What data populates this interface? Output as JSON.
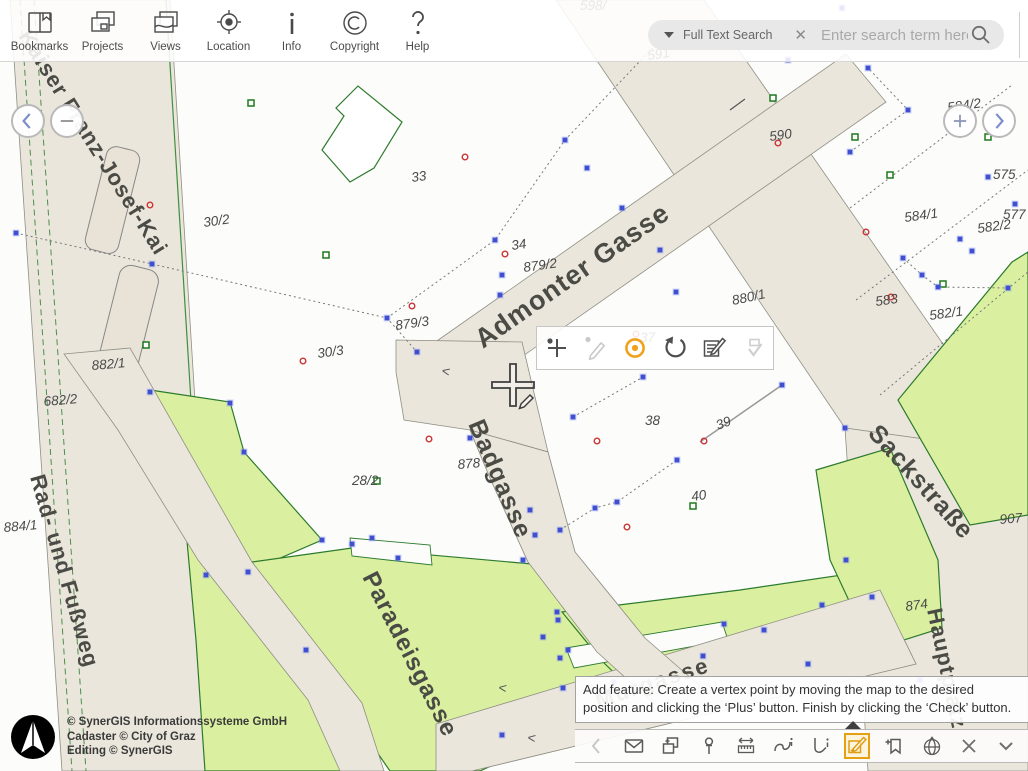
{
  "app_toolbar": {
    "items": [
      {
        "label": "Bookmarks",
        "icon": "book-icon"
      },
      {
        "label": "Projects",
        "icon": "windows-icon"
      },
      {
        "label": "Views",
        "icon": "map-sheet-icon"
      },
      {
        "label": "Location",
        "icon": "target-icon"
      },
      {
        "label": "Info",
        "icon": "info-icon"
      },
      {
        "label": "Copyright",
        "icon": "copyright-icon"
      },
      {
        "label": "Help",
        "icon": "question-icon"
      }
    ]
  },
  "search": {
    "mode_label": "Full Text Search",
    "clear_glyph": "✕",
    "placeholder": "Enter search term here"
  },
  "nav": {
    "pan_left": "chevron-left",
    "zoom_out": "minus",
    "zoom_in": "plus",
    "pan_right": "chevron-right"
  },
  "edit_toolbar": {
    "tools": [
      {
        "name": "add-vertex",
        "state": "enabled"
      },
      {
        "name": "sketch-pencil",
        "state": "disabled"
      },
      {
        "name": "snap-point",
        "state": "active"
      },
      {
        "name": "undo",
        "state": "enabled"
      },
      {
        "name": "edit-attributes",
        "state": "enabled"
      },
      {
        "name": "finish-check",
        "state": "disabled"
      }
    ],
    "accent_color": "#f0a21d"
  },
  "tooltip": {
    "text": "Add feature: Create a vertex point by moving the map to the desired position and clicking the ‘Plus’ button. Finish by clicking the ‘Check’ button."
  },
  "bottom_toolbar": {
    "tools": [
      "previous",
      "email",
      "copy-compare",
      "pin",
      "measure",
      "line-info",
      "area-info",
      "edit-redlining",
      "bookmark-add",
      "globe",
      "close",
      "collapse"
    ],
    "active_tool": "edit-redlining"
  },
  "attribution": {
    "lines": [
      "© SynerGIS Informationssysteme GmbH",
      "Cadaster © City of Graz",
      "Editing © SynerGIS"
    ]
  },
  "map": {
    "colors": {
      "street_fill": "#ebe6dc",
      "green_fill": "#daf0a0",
      "green_stroke": "#2c7a2c",
      "vertex_blue": "#3f4fd0",
      "point_red": "#cc3333",
      "square_green": "#1d7a1d",
      "label_color": "#4a4a4a"
    },
    "street_labels": [
      {
        "t": "Kaiser Franz-Josef-Kai",
        "x": 18,
        "y": 36,
        "r": 58,
        "s": 22,
        "ls": 1
      },
      {
        "t": "Rad- und Fußweg",
        "x": 30,
        "y": 477,
        "r": 74,
        "s": 22,
        "ls": 1
      },
      {
        "t": "Admonter Gasse",
        "x": 483,
        "y": 349,
        "r": -35,
        "s": 27,
        "ls": 1
      },
      {
        "t": "Badgasse",
        "x": 468,
        "y": 424,
        "r": 67,
        "s": 25,
        "ls": 1
      },
      {
        "t": "Paradeisgasse",
        "x": 362,
        "y": 577,
        "r": 63,
        "s": 24,
        "ls": 1
      },
      {
        "t": "Sackstraße",
        "x": 867,
        "y": 434,
        "r": 48,
        "s": 25,
        "ls": 1
      },
      {
        "t": "Hauptplatz",
        "x": 927,
        "y": 610,
        "r": 78,
        "s": 22,
        "ls": 1
      },
      {
        "t": "Murgasse",
        "x": 598,
        "y": 708,
        "r": -18,
        "s": 22,
        "ls": 2
      }
    ],
    "parcel_labels": [
      {
        "t": "33",
        "x": 412,
        "y": 182,
        "r": -8
      },
      {
        "t": "30/2",
        "x": 204,
        "y": 227,
        "r": -8
      },
      {
        "t": "34",
        "x": 512,
        "y": 250,
        "r": -8
      },
      {
        "t": "879/2",
        "x": 524,
        "y": 272,
        "r": -8
      },
      {
        "t": "879/3",
        "x": 396,
        "y": 330,
        "r": -8
      },
      {
        "t": "30/3",
        "x": 318,
        "y": 358,
        "r": -8
      },
      {
        "t": "28/2",
        "x": 352,
        "y": 485,
        "r": 0
      },
      {
        "t": "878",
        "x": 458,
        "y": 469,
        "r": -5
      },
      {
        "t": "38",
        "x": 645,
        "y": 425,
        "r": 0
      },
      {
        "t": "39",
        "x": 718,
        "y": 430,
        "r": -21
      },
      {
        "t": "40",
        "x": 692,
        "y": 501,
        "r": -8
      },
      {
        "t": "880/1",
        "x": 733,
        "y": 305,
        "r": -12
      },
      {
        "t": "882/1",
        "x": 92,
        "y": 370,
        "r": -5
      },
      {
        "t": "682/2",
        "x": 44,
        "y": 406,
        "r": -5
      },
      {
        "t": "884/1",
        "x": 4,
        "y": 532,
        "r": -5
      },
      {
        "t": "583",
        "x": 876,
        "y": 306,
        "r": -8
      },
      {
        "t": "582/1",
        "x": 930,
        "y": 320,
        "r": -8
      },
      {
        "t": "584/1",
        "x": 905,
        "y": 222,
        "r": -8
      },
      {
        "t": "575",
        "x": 993,
        "y": 179,
        "r": 0
      },
      {
        "t": "577",
        "x": 1003,
        "y": 219,
        "r": 0
      },
      {
        "t": "582/2",
        "x": 978,
        "y": 233,
        "r": -8
      },
      {
        "t": "584/2",
        "x": 948,
        "y": 112,
        "r": -8
      },
      {
        "t": "590",
        "x": 770,
        "y": 141,
        "r": -8
      },
      {
        "t": "591",
        "x": 648,
        "y": 60,
        "r": -8
      },
      {
        "t": "589",
        "x": 950,
        "y": 46,
        "r": 0
      },
      {
        "t": "598/",
        "x": 580,
        "y": 10,
        "r": 0
      },
      {
        "t": "907",
        "x": 1000,
        "y": 524,
        "r": -5
      },
      {
        "t": "874",
        "x": 906,
        "y": 611,
        "r": -8
      },
      {
        "t": "37",
        "x": 640,
        "y": 342,
        "r": 0
      }
    ],
    "symbols": {
      "vertices": [
        [
          16,
          233
        ],
        [
          152,
          264
        ],
        [
          387,
          318
        ],
        [
          417,
          352
        ],
        [
          495,
          240
        ],
        [
          565,
          140
        ],
        [
          660,
          40
        ],
        [
          587,
          168
        ],
        [
          622,
          208
        ],
        [
          502,
          275
        ],
        [
          500,
          295
        ],
        [
          573,
          417
        ],
        [
          643,
          377
        ],
        [
          677,
          460
        ],
        [
          782,
          385
        ],
        [
          617,
          502
        ],
        [
          595,
          508
        ],
        [
          560,
          530
        ],
        [
          470,
          438
        ],
        [
          530,
          510
        ],
        [
          535,
          535
        ],
        [
          523,
          560
        ],
        [
          557,
          612
        ],
        [
          558,
          620
        ],
        [
          543,
          637
        ],
        [
          560,
          658
        ],
        [
          563,
          688
        ],
        [
          502,
          735
        ],
        [
          352,
          544
        ],
        [
          372,
          538
        ],
        [
          398,
          558
        ],
        [
          150,
          392
        ],
        [
          230,
          403
        ],
        [
          244,
          452
        ],
        [
          322,
          540
        ],
        [
          248,
          572
        ],
        [
          868,
          68
        ],
        [
          908,
          110
        ],
        [
          850,
          152
        ],
        [
          988,
          177
        ],
        [
          1015,
          204
        ],
        [
          960,
          239
        ],
        [
          972,
          251
        ],
        [
          903,
          258
        ],
        [
          922,
          275
        ],
        [
          938,
          287
        ],
        [
          1008,
          288
        ],
        [
          845,
          428
        ],
        [
          872,
          597
        ],
        [
          846,
          560
        ],
        [
          808,
          664
        ],
        [
          920,
          680
        ],
        [
          788,
          60
        ],
        [
          842,
          8
        ],
        [
          660,
          250
        ],
        [
          676,
          292
        ],
        [
          206,
          575
        ],
        [
          306,
          650
        ],
        [
          614,
          682
        ],
        [
          703,
          656
        ],
        [
          764,
          630
        ],
        [
          822,
          605
        ],
        [
          568,
          650
        ],
        [
          724,
          624
        ]
      ],
      "red_circles": [
        [
          465,
          157
        ],
        [
          150,
          205
        ],
        [
          303,
          361
        ],
        [
          412,
          306
        ],
        [
          429,
          439
        ],
        [
          597,
          441
        ],
        [
          704,
          441
        ],
        [
          627,
          527
        ],
        [
          778,
          143
        ],
        [
          866,
          232
        ],
        [
          891,
          297
        ],
        [
          636,
          334
        ],
        [
          505,
          254
        ]
      ],
      "green_squares": [
        [
          326,
          255
        ],
        [
          146,
          345
        ],
        [
          251,
          103
        ],
        [
          773,
          98
        ],
        [
          855,
          137
        ],
        [
          890,
          175
        ],
        [
          943,
          284
        ],
        [
          377,
          481
        ],
        [
          693,
          506
        ],
        [
          988,
          137
        ]
      ]
    }
  }
}
